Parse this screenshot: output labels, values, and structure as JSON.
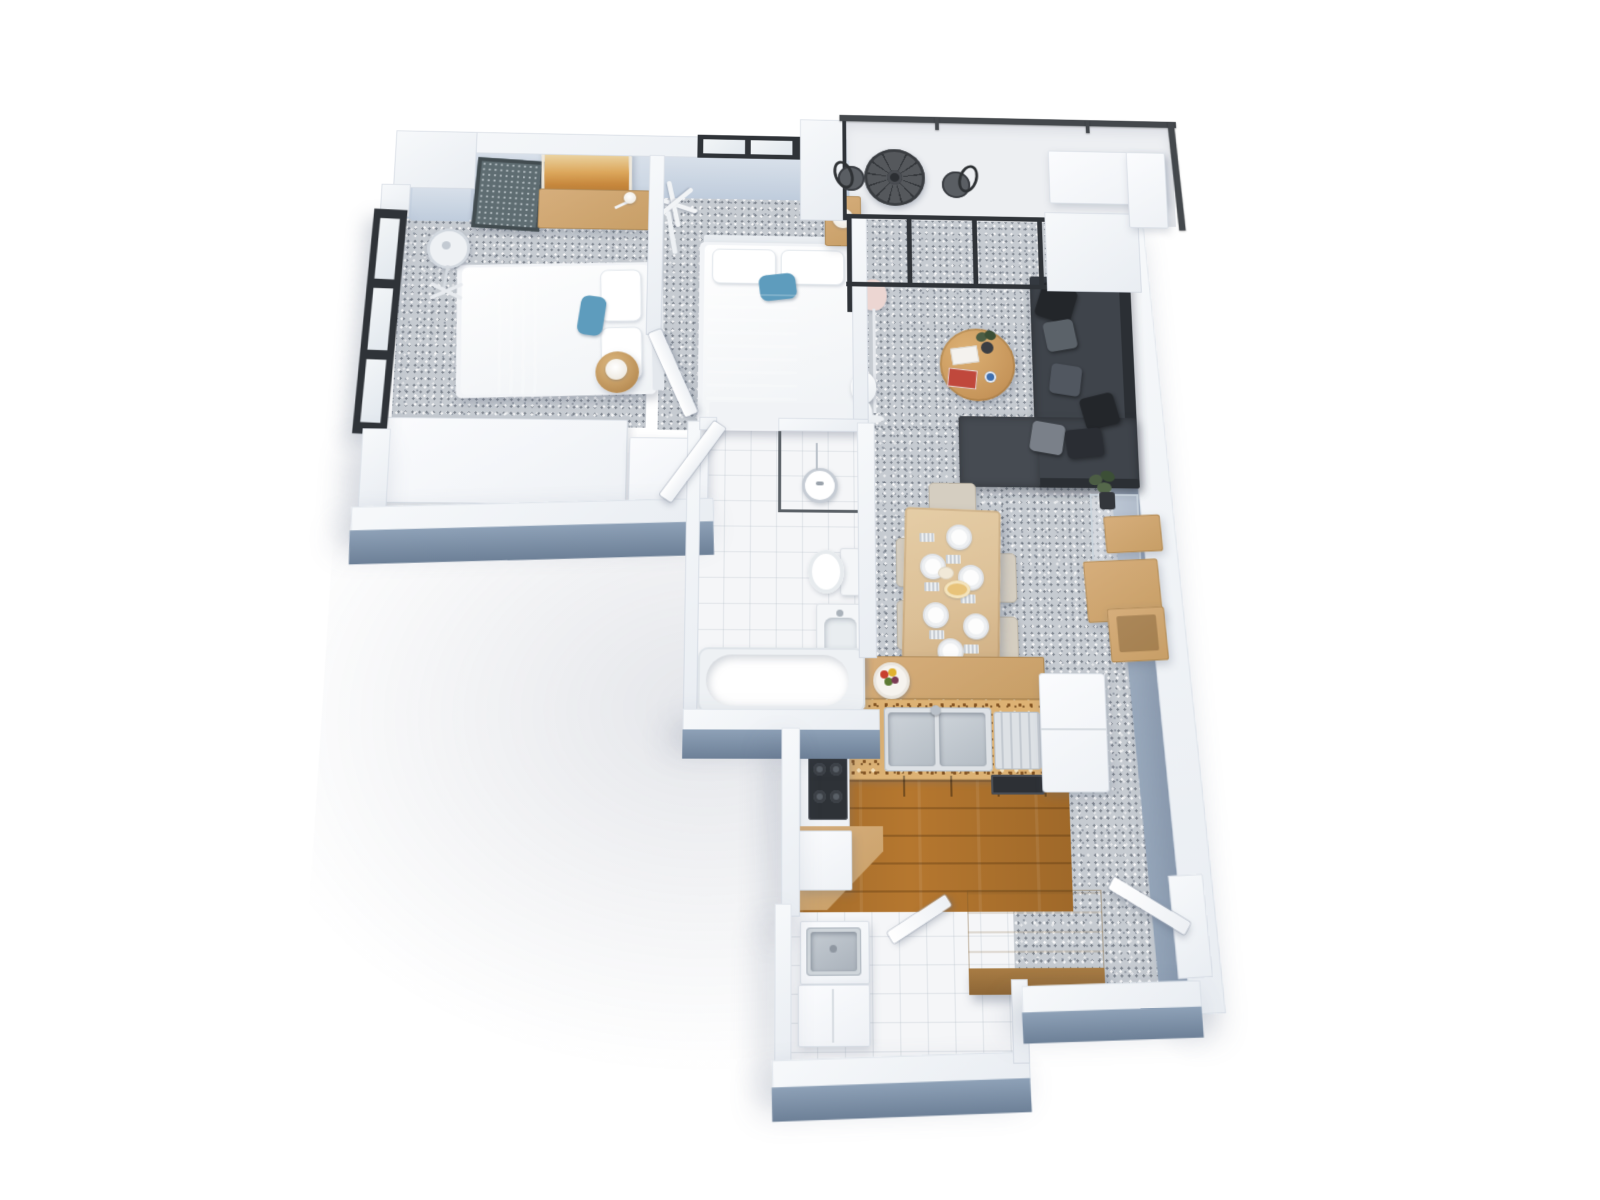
{
  "scene": {
    "type": "3d-floor-plan-render",
    "description": "Top-down 3D dollhouse render of a two-bedroom apartment with balcony, open-plan living/dining, kitchen, bathroom and laundry on a white background",
    "background": "#ffffff"
  },
  "palette": {
    "background": "#ffffff",
    "wallTop": "#f2f4f7",
    "faceLightA": "#d8e0ea",
    "faceLightB": "#bfccdc",
    "faceDarkA": "#8ea1b7",
    "faceDarkB": "#6d8097",
    "faceMidA": "#a9b7c8",
    "faceMidB": "#93a4b8",
    "carpet": "#c6cbd1",
    "tile": "#f5f6f8",
    "balconyFloor": "#edeff2",
    "woodFloor": "#b5772f",
    "granite": "#ddb274",
    "woodFurniture": "#c79e66",
    "woodLight": "#d6ae7c",
    "woodDark": "#a87c44",
    "diningTableWood": "#dcc097",
    "cabinetWood": "#9a6a33",
    "sofa": "#3f444b",
    "sofaShadow": "#2b2f34",
    "sofaChaise": "#464b52",
    "pillowDark": "#23262a",
    "pillowGray": "#5b6269",
    "bedBlue": "#7fb2cd",
    "bedBlueDark": "#5d93b4",
    "accentPillow": "#5e9cbd",
    "railing": "#44484c",
    "windowFrame": "#2f3338",
    "glass": "#eef1f4",
    "fixtureWhite": "#f4f6f8",
    "steel": "#c9cfd6",
    "steelDark": "#aeb6bf",
    "chairBeige": "#d5cec1",
    "chairTrim": "#bdb5a6",
    "lampPink": "#ecd6d2",
    "doorWhite": "#fafbfd",
    "plantGreen": "#4c5d44",
    "plantGreenDark": "#3c4f36",
    "bookRed": "#c0483c",
    "cupBlue": "#3f6fae",
    "artAmberLight": "#ead2a0",
    "artAmber": "#dca75c",
    "artAmberDark": "#b9782f",
    "mirrorGlass": "#5f6d72",
    "mirrorFrame": "#424c50"
  },
  "rooms": [
    {
      "id": "bedroom-1",
      "floor": "carpet",
      "furniture": [
        "double-bed-blue-runner",
        "wardrobe",
        "timber-desk",
        "desk-lamp",
        "amber-wall-art",
        "leaning-mirror",
        "pedestal-fan",
        "round-bedside-table-with-lamp"
      ]
    },
    {
      "id": "bedroom-2",
      "floor": "carpet",
      "furniture": [
        "double-bed-blue-throw",
        "nightstand-with-lamp",
        "white-coat-rack",
        "wardrobe"
      ]
    },
    {
      "id": "living-room",
      "floor": "carpet",
      "furniture": [
        "charcoal-corner-sofa",
        "scatter-cushions",
        "round-timber-coffee-table",
        "books",
        "potted-plant",
        "floor-lamp",
        "white-sculpture",
        "wall-art",
        "glass-side-table"
      ]
    },
    {
      "id": "dining-area",
      "floor": "carpet",
      "furniture": [
        "timber-dining-table",
        "six-upholstered-chairs",
        "six-place-settings",
        "serving-dishes"
      ]
    },
    {
      "id": "tv-wall",
      "floor": "carpet",
      "furniture": [
        "floating-timber-shelf",
        "timber-media-console"
      ]
    },
    {
      "id": "kitchen",
      "floor": "timber",
      "furniture": [
        "granite-counter",
        "double-sink-with-drainer",
        "gas-cooktop",
        "oven",
        "fridge",
        "breakfast-bar",
        "fruit-bowl",
        "corner-bench"
      ]
    },
    {
      "id": "bathroom",
      "floor": "tile",
      "furniture": [
        "walk-in-shower",
        "toilet",
        "vanity-basin",
        "bathtub"
      ]
    },
    {
      "id": "laundry",
      "floor": "tile",
      "furniture": [
        "laundry-trough",
        "base-cabinet",
        "timber-storage-chest"
      ]
    },
    {
      "id": "balcony",
      "floor": "deck",
      "furniture": [
        "mosaic-bistro-table",
        "two-metal-chairs",
        "l-shaped-bench",
        "glass-balustrade"
      ]
    },
    {
      "id": "hallway",
      "floor": "carpet",
      "furniture": []
    },
    {
      "id": "entry",
      "floor": "carpet",
      "furniture": [
        "entry-door"
      ]
    }
  ],
  "openings": {
    "windows": [
      "bedroom-1-left-window-3-pane",
      "bedroom-2-top-window-2-pane",
      "living-room-sliding-glass-doors",
      "balcony-glazing"
    ],
    "doors": [
      "bedroom-1-door",
      "bathroom-door",
      "laundry-door",
      "entry-door"
    ]
  }
}
